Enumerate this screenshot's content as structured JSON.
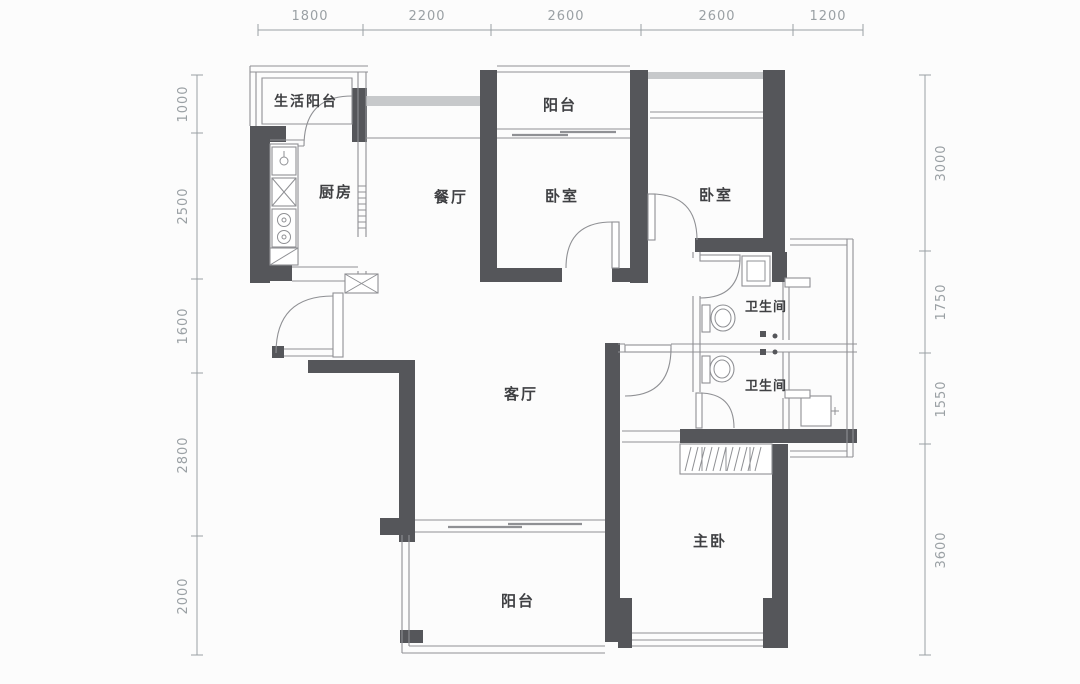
{
  "plan": {
    "type": "apartment-floor-plan"
  },
  "colors": {
    "wall": "#55565a",
    "line": "#8f9094",
    "band": "#c7c9cb",
    "text": "#3f4043",
    "dim": "#9aa0a4"
  },
  "dimensions": {
    "top": [
      "1800",
      "2200",
      "2600",
      "2600",
      "1200"
    ],
    "left": [
      "1000",
      "2500",
      "1600",
      "2800",
      "2000"
    ],
    "right": [
      "3000",
      "1750",
      "1550",
      "3600"
    ]
  },
  "rooms": {
    "service_balcony": "生活阳台",
    "kitchen": "厨房",
    "dining": "餐厅",
    "north_balcony": "阳台",
    "bedroom_north": "卧室",
    "bedroom_east": "卧室",
    "bathroom_upper": "卫生间",
    "bathroom_lower": "卫生间",
    "living": "客厅",
    "master_bedroom": "主卧",
    "south_balcony": "阳台"
  },
  "icons": {
    "sink": "kitchen-sink-icon",
    "stove": "stove-burners-icon",
    "shaft": "duct-shaft-x-icon",
    "toilet": "toilet-icon",
    "water_heater": "water-heater-icon",
    "washer": "washer-tub-icon",
    "wardrobe": "wardrobe-hatch-icon",
    "door": "door-swing-arc-icon",
    "sliding_door": "sliding-door-icon"
  }
}
